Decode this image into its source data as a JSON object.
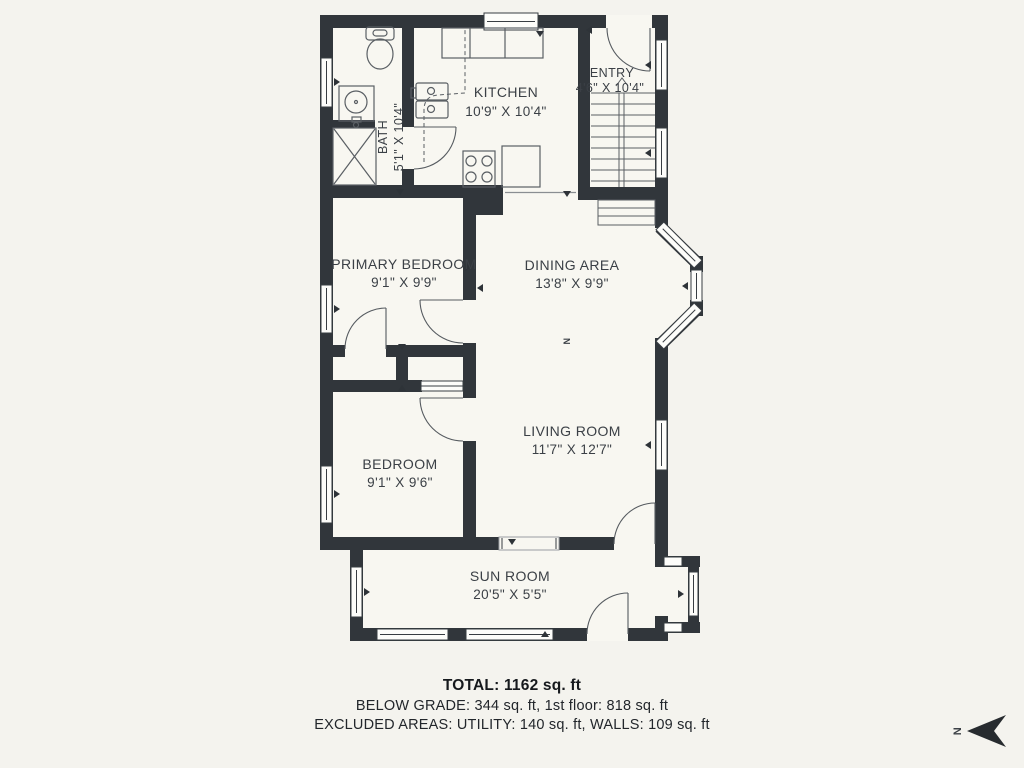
{
  "rooms": {
    "bath": {
      "name": "BATH",
      "dims": "5'1\" X 10'4\""
    },
    "kitchen": {
      "name": "KITCHEN",
      "dims": "10'9\" X 10'4\""
    },
    "entry": {
      "name": "ENTRY",
      "dims": "4'6\" X 10'4\""
    },
    "primary": {
      "name": "PRIMARY BEDROOM",
      "dims": "9'1\" X 9'9\""
    },
    "dining": {
      "name": "DINING AREA",
      "dims": "13'8\" X 9'9\""
    },
    "bedroom": {
      "name": "BEDROOM",
      "dims": "9'1\" X 9'6\""
    },
    "living": {
      "name": "LIVING ROOM",
      "dims": "11'7\" X 12'7\""
    },
    "sunroom": {
      "name": "SUN ROOM",
      "dims": "20'5\" X 5'5\""
    }
  },
  "summary": {
    "total": "TOTAL: 1162 sq. ft",
    "line2": "BELOW GRADE: 344 sq. ft, 1st floor: 818 sq. ft",
    "line3": "EXCLUDED AREAS: UTILITY: 140 sq. ft, WALLS: 109 sq. ft"
  },
  "compass": {
    "label": "N"
  },
  "colors": {
    "background": "#f4f3ee",
    "wall": "#31363b",
    "floor": "#f8f7f1",
    "fixture_line": "#5a5f64",
    "text": "#3b4046",
    "compass": "#272b2f"
  }
}
